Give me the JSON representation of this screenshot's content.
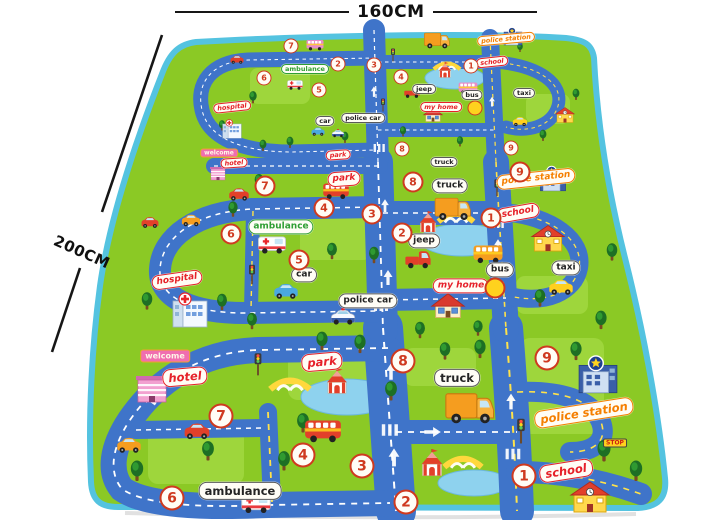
{
  "annotations": {
    "width_label": "160CM",
    "length_label": "200CM"
  },
  "colors": {
    "mat_green": "#8bc925",
    "trim": "#54c3e0",
    "road": "#3f74c9",
    "label_red": "#e62129",
    "label_green": "#2f9e34",
    "label_black": "#242424",
    "label_orange": "#f57f00",
    "sign_bg": "#f06eb0",
    "badge_ring": "#cf3a1f",
    "stop_bg": "#ffd21e"
  },
  "mat": {
    "labels": [
      {
        "text": "ambulance",
        "color": "green",
        "x": 305,
        "y": 69,
        "s": 1
      },
      {
        "text": "hospital",
        "color": "red",
        "x": 232,
        "y": 107,
        "s": 1,
        "rot": -6,
        "script": true
      },
      {
        "text": "car",
        "color": "black",
        "x": 325,
        "y": 121,
        "s": 1
      },
      {
        "text": "police car",
        "color": "black",
        "x": 363,
        "y": 118,
        "s": 1
      },
      {
        "text": "welcome",
        "x": 219,
        "y": 153,
        "s": 1,
        "kind": "sign"
      },
      {
        "text": "hotel",
        "color": "red",
        "x": 234,
        "y": 163,
        "s": 1,
        "rot": -4,
        "script": true
      },
      {
        "text": "park",
        "color": "red",
        "x": 338,
        "y": 155,
        "s": 1,
        "rot": -4,
        "script": true
      },
      {
        "text": "jeep",
        "color": "black",
        "x": 424,
        "y": 89,
        "s": 1
      },
      {
        "text": "school",
        "color": "red",
        "x": 492,
        "y": 62,
        "s": 1,
        "rot": -6,
        "script": true
      },
      {
        "text": "bus",
        "color": "black",
        "x": 472,
        "y": 95,
        "s": 1
      },
      {
        "text": "taxi",
        "color": "black",
        "x": 524,
        "y": 93,
        "s": 1
      },
      {
        "text": "my home",
        "color": "red",
        "x": 441,
        "y": 107,
        "s": 1,
        "script": true
      },
      {
        "text": "truck",
        "color": "black",
        "x": 444,
        "y": 162,
        "s": 1
      },
      {
        "text": "police station",
        "color": "orange",
        "x": 506,
        "y": 39,
        "s": 1,
        "rot": -5,
        "script": true
      },
      {
        "text": "ambulance",
        "color": "green",
        "x": 281,
        "y": 227,
        "s": 2
      },
      {
        "text": "hospital",
        "color": "red",
        "x": 177,
        "y": 280,
        "s": 2,
        "rot": -8,
        "script": true
      },
      {
        "text": "car",
        "color": "black",
        "x": 304,
        "y": 275,
        "s": 2
      },
      {
        "text": "police car",
        "color": "black",
        "x": 368,
        "y": 301,
        "s": 2
      },
      {
        "text": "jeep",
        "color": "black",
        "x": 424,
        "y": 241,
        "s": 2
      },
      {
        "text": "school",
        "color": "red",
        "x": 518,
        "y": 213,
        "s": 2,
        "rot": -10,
        "script": true
      },
      {
        "text": "bus",
        "color": "black",
        "x": 500,
        "y": 270,
        "s": 2
      },
      {
        "text": "taxi",
        "color": "black",
        "x": 566,
        "y": 268,
        "s": 2
      },
      {
        "text": "my home",
        "color": "red",
        "x": 461,
        "y": 286,
        "s": 2,
        "script": true
      },
      {
        "text": "truck",
        "color": "black",
        "x": 450,
        "y": 186,
        "s": 2
      },
      {
        "text": "police station",
        "color": "orange",
        "x": 536,
        "y": 179,
        "s": 2,
        "rot": -6,
        "script": true
      },
      {
        "text": "park",
        "color": "red",
        "x": 344,
        "y": 179,
        "s": 2,
        "rot": -4,
        "script": true
      },
      {
        "text": "welcome",
        "x": 165,
        "y": 356,
        "s": 2,
        "kind": "sign"
      },
      {
        "text": "hotel",
        "color": "red",
        "x": 185,
        "y": 377,
        "s": 3,
        "rot": -5,
        "script": true
      },
      {
        "text": "park",
        "color": "red",
        "x": 322,
        "y": 362,
        "s": 3,
        "rot": -5,
        "script": true
      },
      {
        "text": "ambulance",
        "color": "black",
        "x": 240,
        "y": 491,
        "s": 3
      },
      {
        "text": "truck",
        "color": "black",
        "x": 457,
        "y": 378,
        "s": 3
      },
      {
        "text": "school",
        "color": "red",
        "x": 566,
        "y": 471,
        "s": 3,
        "rot": -9,
        "script": true
      },
      {
        "text": "police station",
        "color": "orange",
        "x": 584,
        "y": 413,
        "s": 3,
        "rot": -9,
        "script": true
      },
      {
        "text": "STOP",
        "x": 615,
        "y": 443,
        "s": 1,
        "kind": "stop"
      }
    ],
    "badges": [
      {
        "n": "7",
        "x": 291,
        "y": 46,
        "s": 1
      },
      {
        "n": "6",
        "x": 264,
        "y": 78,
        "s": 1
      },
      {
        "n": "2",
        "x": 338,
        "y": 64,
        "s": 1
      },
      {
        "n": "3",
        "x": 374,
        "y": 65,
        "s": 1
      },
      {
        "n": "4",
        "x": 401,
        "y": 77,
        "s": 1
      },
      {
        "n": "5",
        "x": 319,
        "y": 90,
        "s": 1
      },
      {
        "n": "1",
        "x": 471,
        "y": 66,
        "s": 1
      },
      {
        "n": "",
        "x": 475,
        "y": 108,
        "s": 1,
        "dot": true
      },
      {
        "n": "8",
        "x": 402,
        "y": 149,
        "s": 1
      },
      {
        "n": "9",
        "x": 511,
        "y": 148,
        "s": 1
      },
      {
        "n": "7",
        "x": 265,
        "y": 186,
        "s": 2
      },
      {
        "n": "6",
        "x": 231,
        "y": 234,
        "s": 2
      },
      {
        "n": "5",
        "x": 299,
        "y": 260,
        "s": 2
      },
      {
        "n": "4",
        "x": 324,
        "y": 208,
        "s": 2
      },
      {
        "n": "3",
        "x": 372,
        "y": 214,
        "s": 2
      },
      {
        "n": "2",
        "x": 402,
        "y": 233,
        "s": 2
      },
      {
        "n": "1",
        "x": 491,
        "y": 218,
        "s": 2
      },
      {
        "n": "",
        "x": 495,
        "y": 288,
        "s": 2,
        "dot": true
      },
      {
        "n": "8",
        "x": 413,
        "y": 182,
        "s": 2
      },
      {
        "n": "9",
        "x": 520,
        "y": 172,
        "s": 2
      },
      {
        "n": "8",
        "x": 403,
        "y": 361,
        "s": 3
      },
      {
        "n": "9",
        "x": 547,
        "y": 358,
        "s": 3
      },
      {
        "n": "7",
        "x": 221,
        "y": 416,
        "s": 3
      },
      {
        "n": "4",
        "x": 303,
        "y": 455,
        "s": 3
      },
      {
        "n": "3",
        "x": 362,
        "y": 466,
        "s": 3
      },
      {
        "n": "6",
        "x": 172,
        "y": 498,
        "s": 3
      },
      {
        "n": "2",
        "x": 406,
        "y": 502,
        "s": 3
      },
      {
        "n": "1",
        "x": 524,
        "y": 476,
        "s": 3
      }
    ]
  }
}
